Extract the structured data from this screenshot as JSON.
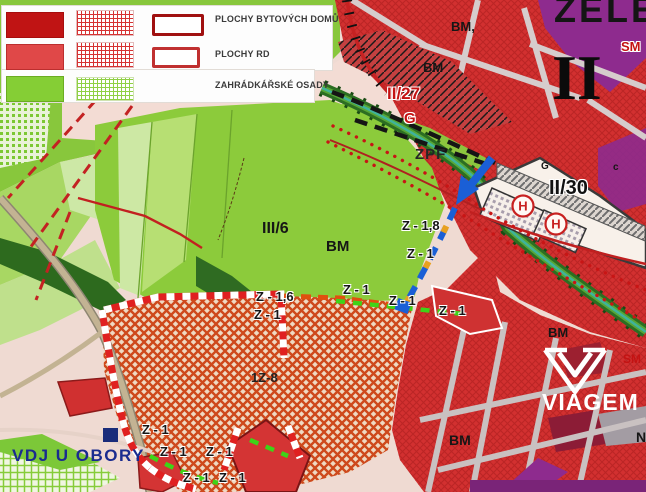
{
  "legend": {
    "items": [
      {
        "label": "PLOCHY BYTOVÝCH DOMŮ",
        "solid_color": "#c01414",
        "hatch_color": "#d63232"
      },
      {
        "label": "PLOCHY RD",
        "solid_color": "#e04848",
        "hatch_color": "#d63232"
      },
      {
        "label": "ZAHRÁDKÁŘSKÉ OSADY",
        "solid_color": "#85ce35",
        "hatch_color": "#8fd044"
      }
    ]
  },
  "labels": {
    "zele": "ZELE",
    "roman_two": "II",
    "sm_top": "SM",
    "bm_top_a": "BM,",
    "bm_top_b": "BM",
    "ii27": "II/27",
    "g_red": "G",
    "zpf": "ZPF",
    "g_small": "G",
    "c_small": "c",
    "ii30": "II/30",
    "h_symbol": "H",
    "iii6": "III/6",
    "bm_center": "BM",
    "z18": "Z - 1,8",
    "z16": "Z - 1,6",
    "z1": "Z - 1",
    "iz8": "1Z-8",
    "vdj": "VDJ U OBORY",
    "bm_right": "BM",
    "sm_right": "SM",
    "viagem": "VIAGEM",
    "bm_bottom": "BM",
    "n_bottom": "N"
  },
  "colors": {
    "apartment_red": "#c01414",
    "rd_red": "#e04848",
    "garden_green": "#85ce35",
    "urban_red": "#d23030",
    "purple": "#8e2b8e",
    "zone_hatch_orange": "#ce491c",
    "route_blue": "#1a5fd6",
    "boundary_stripe_red": "#e02020",
    "vdj_text_blue": "#1a2b8f"
  }
}
